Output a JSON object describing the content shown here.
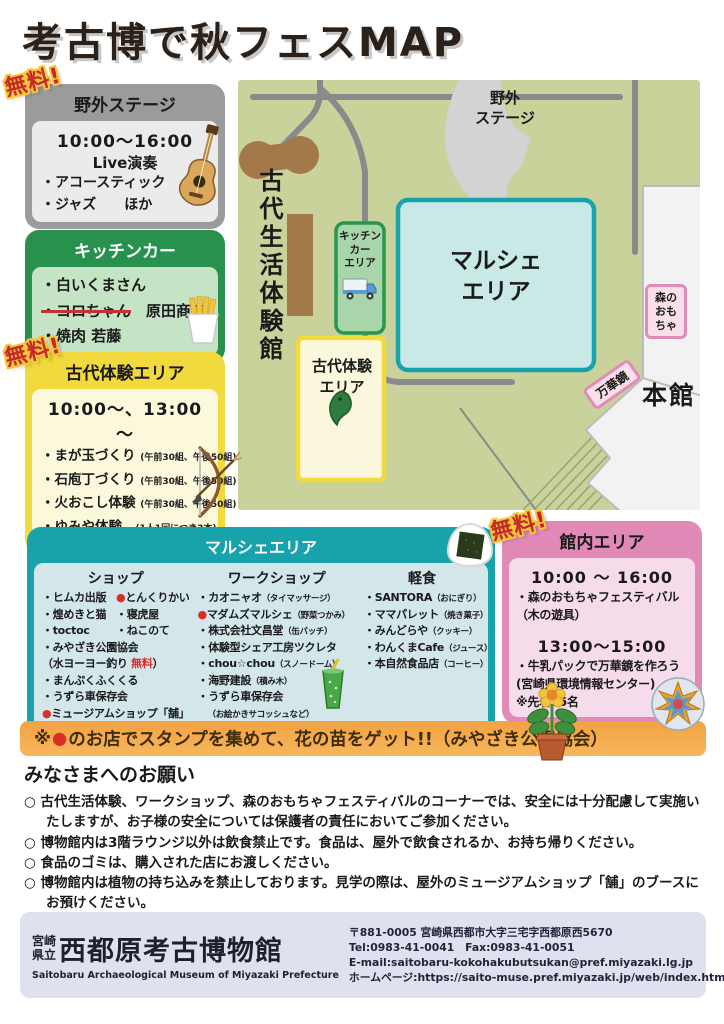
{
  "title": "考古博で秋フェスMAP",
  "badge_free": "無料!",
  "stage": {
    "title": "野外ステージ",
    "time": "10:00～16:00",
    "live": "Live演奏",
    "items": [
      "・アコースティック",
      "・ジャズ　　ほか"
    ]
  },
  "kitchen": {
    "title": "キッチンカー",
    "item1": "・白いくまさん",
    "item2_strike": "・コロちゃん",
    "item2_rest": "原田商店",
    "item3": "・焼肉 若藤"
  },
  "kodai": {
    "title": "古代体験エリア",
    "time": "10:00～、13:00～",
    "items": [
      {
        "t": "・まが玉づくり",
        "n": "(午前30組、午後50組)"
      },
      {
        "t": "・石庖丁づくり",
        "n": "(午前30組、午後50組)"
      },
      {
        "t": "・火おこし体験",
        "n": "(午前30組、午後50組)"
      },
      {
        "t": "・ゆみや体験",
        "n": "(1人1回につき3本)"
      }
    ]
  },
  "map": {
    "stage_l1": "野外",
    "stage_l2": "ステージ",
    "taikenkan": "古代生活体験館",
    "kitchen_l1": "キッチン",
    "kitchen_l2": "カー",
    "kitchen_l3": "エリア",
    "marche_l1": "マルシェ",
    "marche_l2": "エリア",
    "kodai_l1": "古代体験",
    "kodai_l2": "エリア",
    "mori_l1": "森の",
    "mori_l2": "おも",
    "mori_l3": "ちゃ",
    "mangekyo": "万華鏡",
    "honkan": "本館"
  },
  "marche": {
    "title": "マルシェエリア",
    "shop": {
      "title": "ショップ",
      "pairs": [
        [
          {
            "b": "・",
            "t": "ヒムカ出版"
          },
          {
            "b": "●",
            "t": "とんくりかい"
          }
        ],
        [
          {
            "b": "・",
            "t": "煌めきと猫"
          },
          {
            "b": "・",
            "t": "寝虎屋"
          }
        ],
        [
          {
            "b": "・",
            "t": "toctoc"
          },
          {
            "b": "・",
            "t": "ねこのて"
          }
        ]
      ],
      "r1": "・みやざき公園協会",
      "r2_pre": "（水ヨーヨー釣り ",
      "r2_red": "無料",
      "r2_post": "）",
      "r3": "・まんぷくふくくる",
      "r4": "・うずら車保存会",
      "r5_b": "●",
      "r5_t": "ミュージアムショップ「舗」"
    },
    "workshop": {
      "title": "ワークショップ",
      "items": [
        {
          "b": "・",
          "t": "カオニャオ",
          "n": "（タイマッサージ）"
        },
        {
          "b": "●",
          "t": "マダムズマルシェ",
          "n": "（野菜つかみ）"
        },
        {
          "b": "・",
          "t": "株式会社文昌堂",
          "n": "（缶バッチ）"
        },
        {
          "b": "・",
          "t": "体験型シェア工房ツクレタ",
          "n": ""
        },
        {
          "b": "・",
          "t": "chou☆chou",
          "n": "（スノードーム）"
        },
        {
          "b": "・",
          "t": "海野建設",
          "n": "（積み木）"
        },
        {
          "b": "・",
          "t": "うずら車保存会",
          "n": ""
        },
        {
          "b": "",
          "t": "",
          "n": "（お絵かきサコッシュなど）"
        }
      ]
    },
    "food": {
      "title": "軽食",
      "items": [
        {
          "b": "・",
          "t": "SANTORA",
          "n": "（おにぎり）"
        },
        {
          "b": "・",
          "t": "ママパレット",
          "n": "（焼き菓子）"
        },
        {
          "b": "・",
          "t": "みんどらや",
          "n": "（クッキー）"
        },
        {
          "b": "・",
          "t": "わんくまCafe",
          "n": "（ジュース）"
        },
        {
          "b": "・",
          "t": "本自然食品店",
          "n": "（コーヒー）"
        }
      ]
    }
  },
  "kannai": {
    "title": "館内エリア",
    "time1": "10:00 ～ 16:00",
    "line1": "・森のおもちゃフェスティバル",
    "line1b": "（木の遊具）",
    "time2": "13:00～15:00",
    "line2": "・牛乳パックで万華鏡を作ろう",
    "line2b": "(宮崎県環境情報センター)",
    "line2c": "※先着35名"
  },
  "stamp": {
    "pre": "※",
    "dot": "●",
    "text": "のお店でスタンプを集めて、花の苗をゲット!!（みやざき公園協会）"
  },
  "notice": {
    "title": "みなさまへのお願い",
    "items": [
      "○ 古代生活体験、ワークショップ、森のおもちゃフェスティバルのコーナーでは、安全には十分配慮して実施いたしますが、お子様の安全については保護者の責任においてご参加ください。",
      "○ 博物館内は3階ラウンジ以外は飲食禁止です。食品は、屋外で飲食されるか、お持ち帰りください。",
      "○ 食品のゴミは、購入された店にお渡しください。",
      "○ 博物館内は植物の持ち込みを禁止しております。見学の際は、屋外のミュージアムショップ「舗」のブースにお預けください。"
    ]
  },
  "footer": {
    "pref_l1": "宮崎",
    "pref_l2": "県立",
    "museum": "西都原考古博物館",
    "english": "Saitobaru Archaeological Museum of Miyazaki Prefecture",
    "address": "〒881-0005 宮崎県西都市大字三宅字西都原西5670",
    "tel": "Tel:0983-41-0041　Fax:0983-41-0051",
    "email": "E-mail:saitobaru-kokohakubutsukan@pref.miyazaki.lg.jp",
    "homepage": "ホームページ:https://saito-muse.pref.miyazaki.jp/web/index.html",
    "qr_label1": "ホームページ",
    "qr_label2": "Facebook"
  },
  "icons": {
    "guitar": "guitar-icon",
    "fries": "fries-icon",
    "bow": "bow-arrow-icon",
    "truck": "food-truck-icon",
    "magatama": "magatama-icon",
    "drink": "drink-icon",
    "onigiri": "onigiri-icon",
    "kaleidoscope": "kaleidoscope-icon",
    "flower": "flower-pot-icon",
    "qr": "qr-code-icon"
  },
  "colors": {
    "stage_frame": "#9b9b9b",
    "kitchen_frame": "#28914e",
    "kodai_frame": "#f2d93d",
    "marche_frame": "#17a2ac",
    "kannai_frame": "#e18ab8",
    "banner": "#f4a94e",
    "badge_red": "#c62828",
    "badge_yellow": "#f4c63c",
    "map_bg": "#c9d29b",
    "road": "#8a8a8a",
    "accent_red": "#d93025"
  }
}
